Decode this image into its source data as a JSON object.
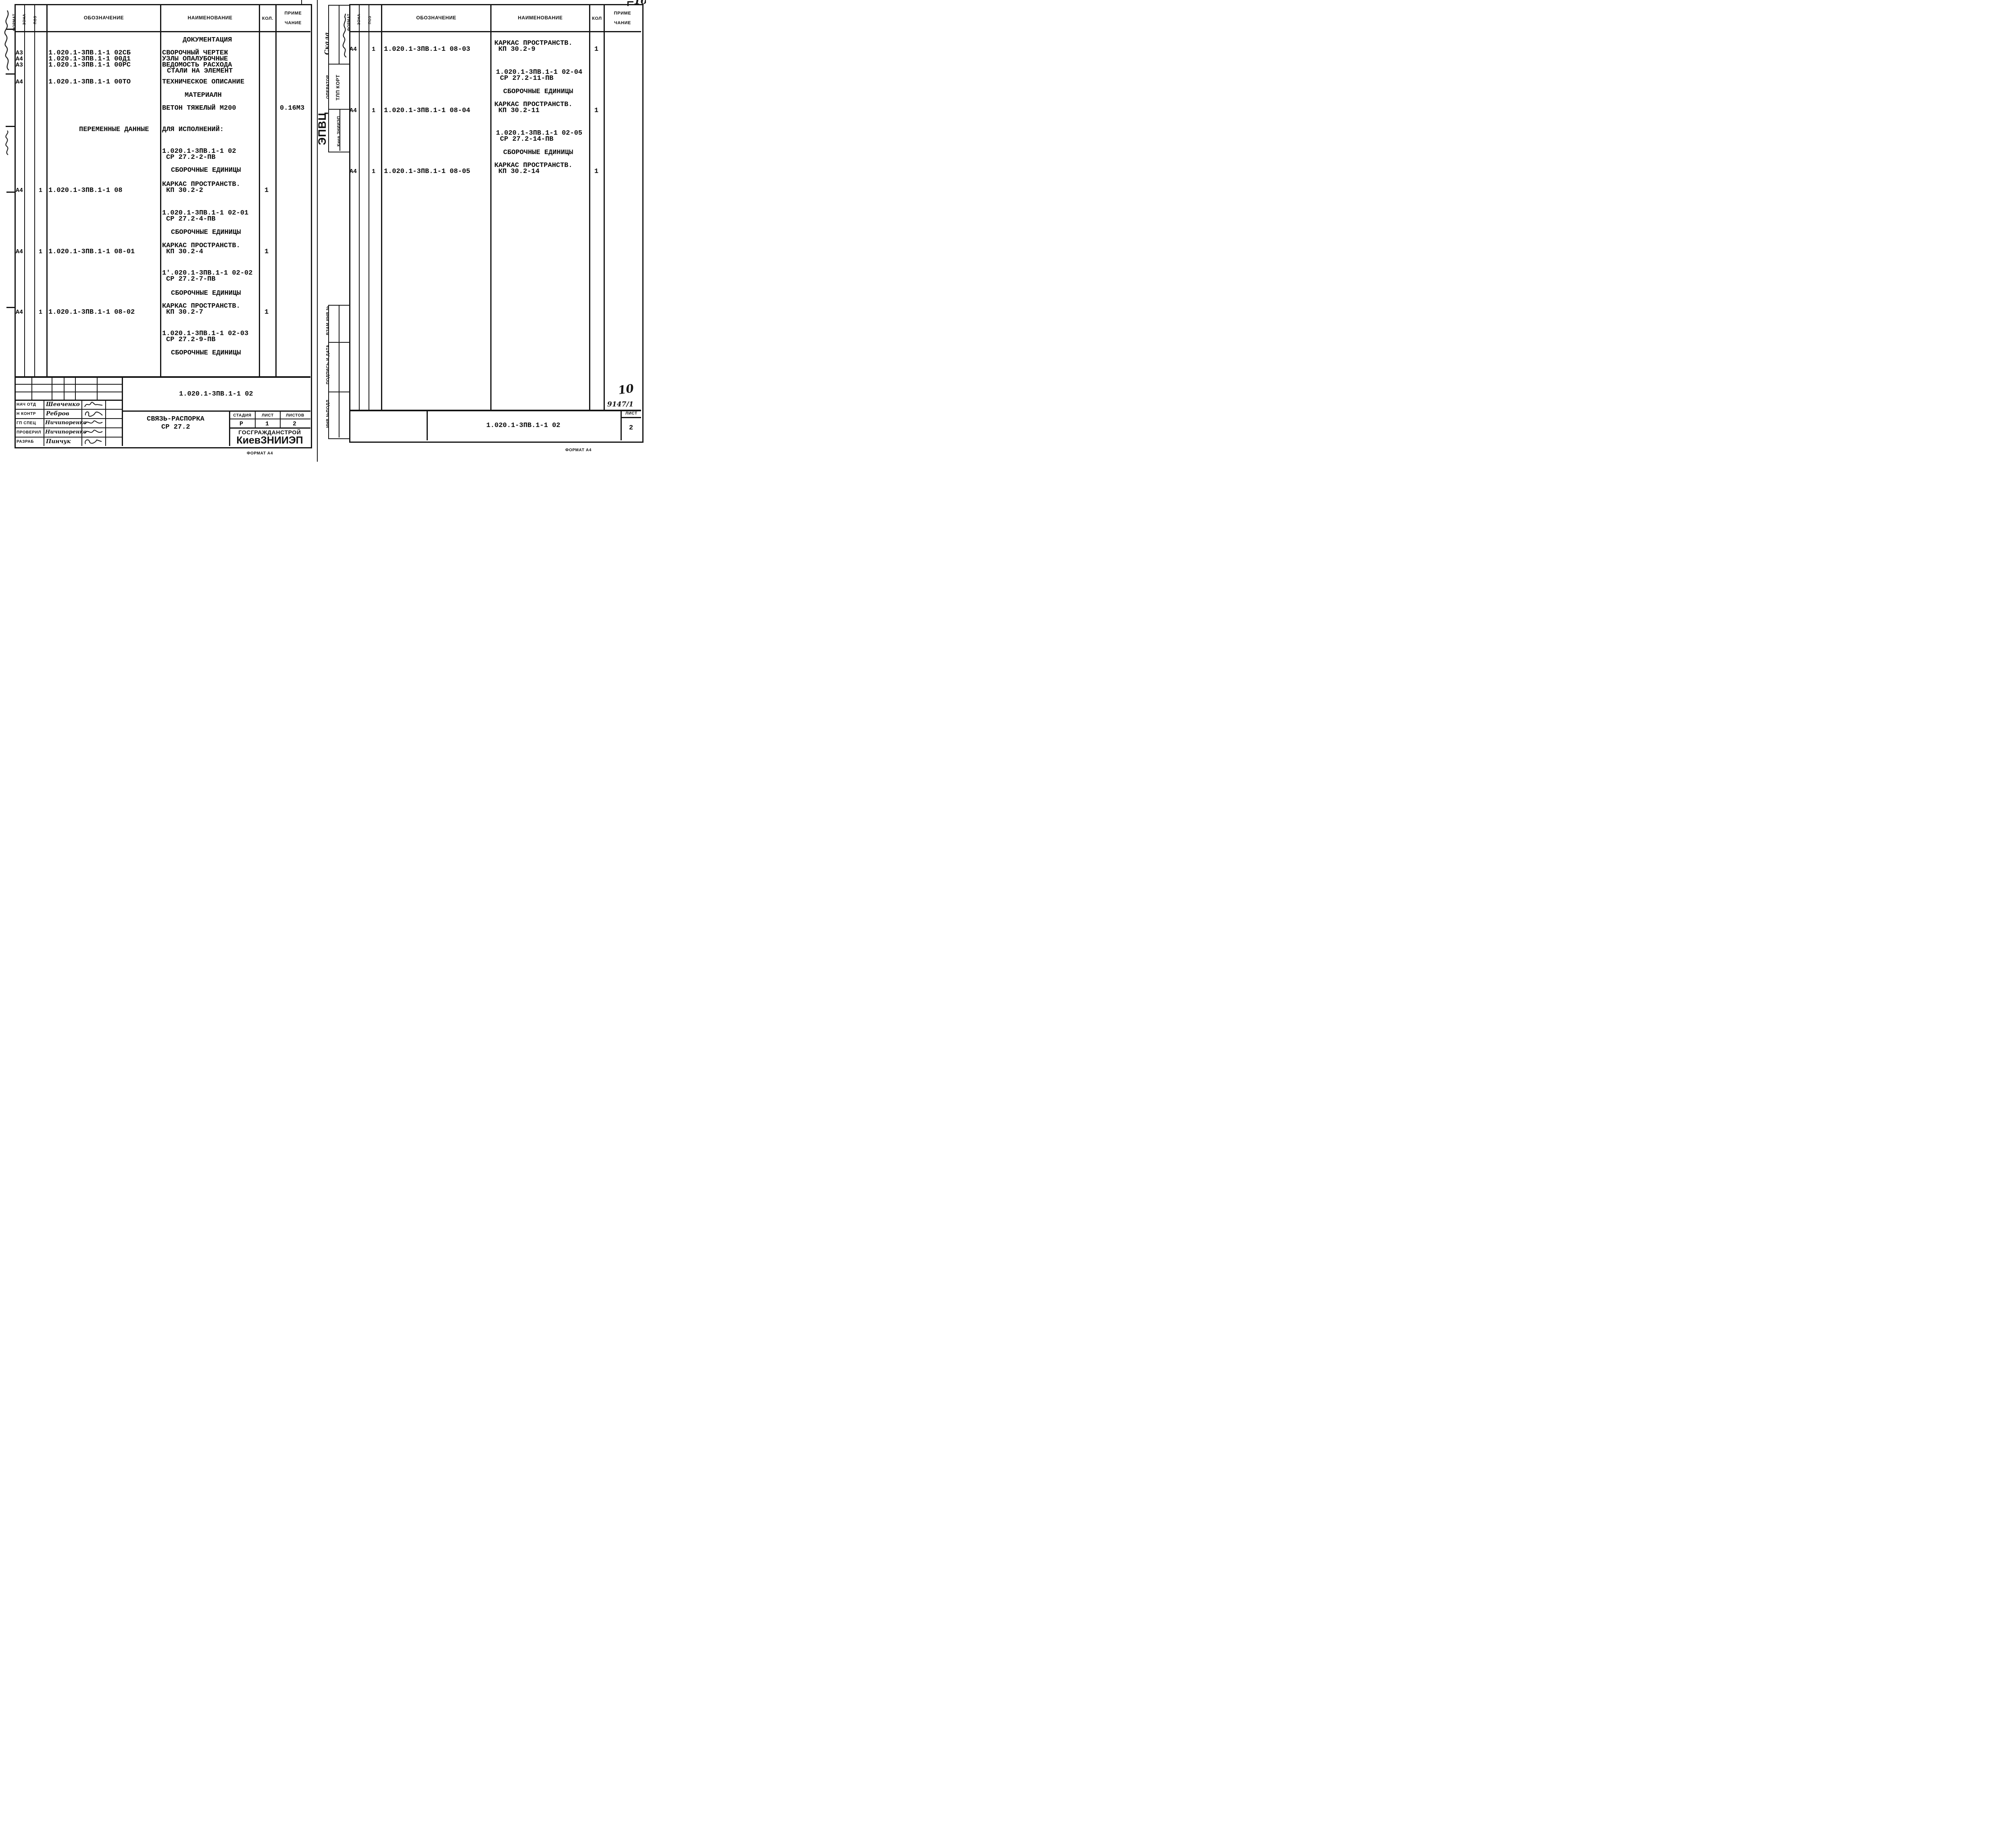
{
  "left": {
    "header": {
      "format": "ФОРМАТ",
      "zone": "ЗОНА",
      "pos": "ПОЗ",
      "designation": "ОБОЗНАЧЕНИЕ",
      "name": "НАИМЕНОВАНИЕ",
      "qty": "КОЛ.",
      "note_line1": "ПРИМЕ",
      "note_line2": "ЧАНИЕ"
    },
    "formats": [
      "А3",
      "А4",
      "А3",
      "А4",
      "А4",
      "А4",
      "А4"
    ],
    "positions": [
      "1",
      "1",
      "1"
    ],
    "designations": [
      "1.020.1-3ПВ.1-1 02СБ",
      "1.020.1-3ПВ.1-1 00Д1",
      "1.020.1-3ПВ.1-1 00РС",
      "1.020.1-3ПВ.1-1 00ТО",
      "ПЕРЕМЕННЫЕ ДАННЫЕ",
      "1.020.1-3ПВ.1-1 08",
      "1.020.1-3ПВ.1-1 08-01",
      "1.020.1-3ПВ.1-1 08-02"
    ],
    "names": [
      "ДОКУМЕНТАЦИЯ",
      "СВОРОЧНЫЙ ЧЕРТЕЖ",
      "УЗЛЫ ОПАЛУБОЧНЫЕ",
      "ВЕДОМОСТЬ РАСХОДА",
      "СТАЛИ НА ЭЛЕМЕНТ",
      "ТЕХНИЧЕСКОЕ ОПИСАНИЕ",
      "МАТЕРИАЛН",
      "ВЕТОН ТЯЖЕЛЫЙ М200",
      "ДЛЯ ИСПОЛНЕНИЙ:",
      "1.020.1-3ПВ.1-1 02",
      "СР 27.2-2-ПВ",
      "СБОРОЧНЫЕ ЕДИНИЦЫ",
      "КАРКАС ПРОСТРАНСТВ.",
      "КП 30.2-2",
      "1.020.1-3ПВ.1-1 02-01",
      "СР 27.2-4-ПВ",
      "СБОРОЧНЫЕ ЕДИНИЦЫ",
      "КАРКАС ПРОСТРАНСТВ.",
      "КП 30.2-4",
      "1'.020.1-3ПВ.1-1 02-02",
      "СР 27.2-7-ПВ",
      "СБОРОЧНЫЕ ЕДИНИЦЫ",
      "КАРКАС ПРОСТРАНСТВ.",
      "КП 30.2-7",
      "1.020.1-3ПВ.1-1 02-03",
      "СР 27.2-9-ПВ",
      "СБОРОЧНЫЕ ЕДИНИЦЫ"
    ],
    "qtys": [
      "1",
      "1",
      "1"
    ],
    "notes": [
      "0.16М3"
    ],
    "title_block": {
      "doc_number": "1.020.1-3ПВ.1-1 02",
      "product_name": "СВЯЗЬ-РАСПОРКА",
      "product_code": "СР 27.2",
      "stage_label": "СТАДИЯ",
      "sheet_label": "ЛИСТ",
      "sheets_label": "ЛИСТОВ",
      "stage": "Р",
      "sheet": "1",
      "sheets": "2",
      "org_line1": "ГОСГРАЖДАНСТРОЙ",
      "org_line2": "КиевЗНИИЭП",
      "rows": [
        {
          "role": "НАЧ ОТД",
          "name": "Шевченко"
        },
        {
          "role": "Н КОНТР",
          "name": "Ребров"
        },
        {
          "role": "ГП СПЕЦ",
          "name": "Ничипоренко"
        },
        {
          "role": "ПРОВЕРИЛ",
          "name": "Ничипоренко"
        },
        {
          "role": "РАЗРАБ",
          "name": "Пинчук"
        }
      ]
    },
    "format_label": "ФОРМАТ А4"
  },
  "right": {
    "header": {
      "format": "ФОРМАТ",
      "zone": "ЗОНА",
      "pos": "ПОЗ",
      "designation": "ОБОЗНАЧЕНИЕ",
      "name": "НАИМЕНОВАНИЕ",
      "qty": "КОЛ",
      "note_line1": "ПРИМЕ",
      "note_line2": "ЧАНИЕ"
    },
    "formats": [
      "А4",
      "А4",
      "А4"
    ],
    "positions": [
      "1",
      "1",
      "1"
    ],
    "designations": [
      "1.020.1-3ПВ.1-1 08-03",
      "1.020.1-3ПВ.1-1 08-04",
      "1.020.1-3ПВ.1-1 08-05"
    ],
    "names": [
      "КАРКАС ПРОСТРАНСТВ.",
      "КП 30.2-9",
      "1.020.1-3ПВ.1-1 02-04",
      "СР 27.2-11-ПВ",
      "СБОРОЧНЫЕ ЕДИНИЦЫ",
      "КАРКАС ПРОСТРАНСТВ.",
      "КП 30.2-11",
      "1.020.1-3ПВ.1-1 02-05",
      "СР 27.2-14-ПВ",
      "СБОРОЧНЫЕ ЕДИНИЦЫ",
      "КАРКАС ПРОСТРАНСТВ.",
      "КП 30.2-14"
    ],
    "qtys": [
      "1",
      "1",
      "1"
    ],
    "sidebar": {
      "note": "Скала",
      "operator_label": "ОПЕРАТОР",
      "operator_value": "ТЛП КОРТ",
      "org_abbr": "ЭПВЦ",
      "org_name": "Киев ЗНИИЭП",
      "vzam_label": "ВЗАМ ИНВ №",
      "podpis_label": "ПОДПИСЬ И ДАТА",
      "inv_label": "ИНВ №ПОДЛ"
    },
    "title_block": {
      "doc_number": "1.020.1-3ПВ.1-1 02",
      "sheet_label": "ЛИСТ",
      "sheet_number": "2",
      "order_number": "9147/1",
      "page_number": "10",
      "corner_number": "10"
    },
    "format_label": "ФОРМАТ А4"
  }
}
